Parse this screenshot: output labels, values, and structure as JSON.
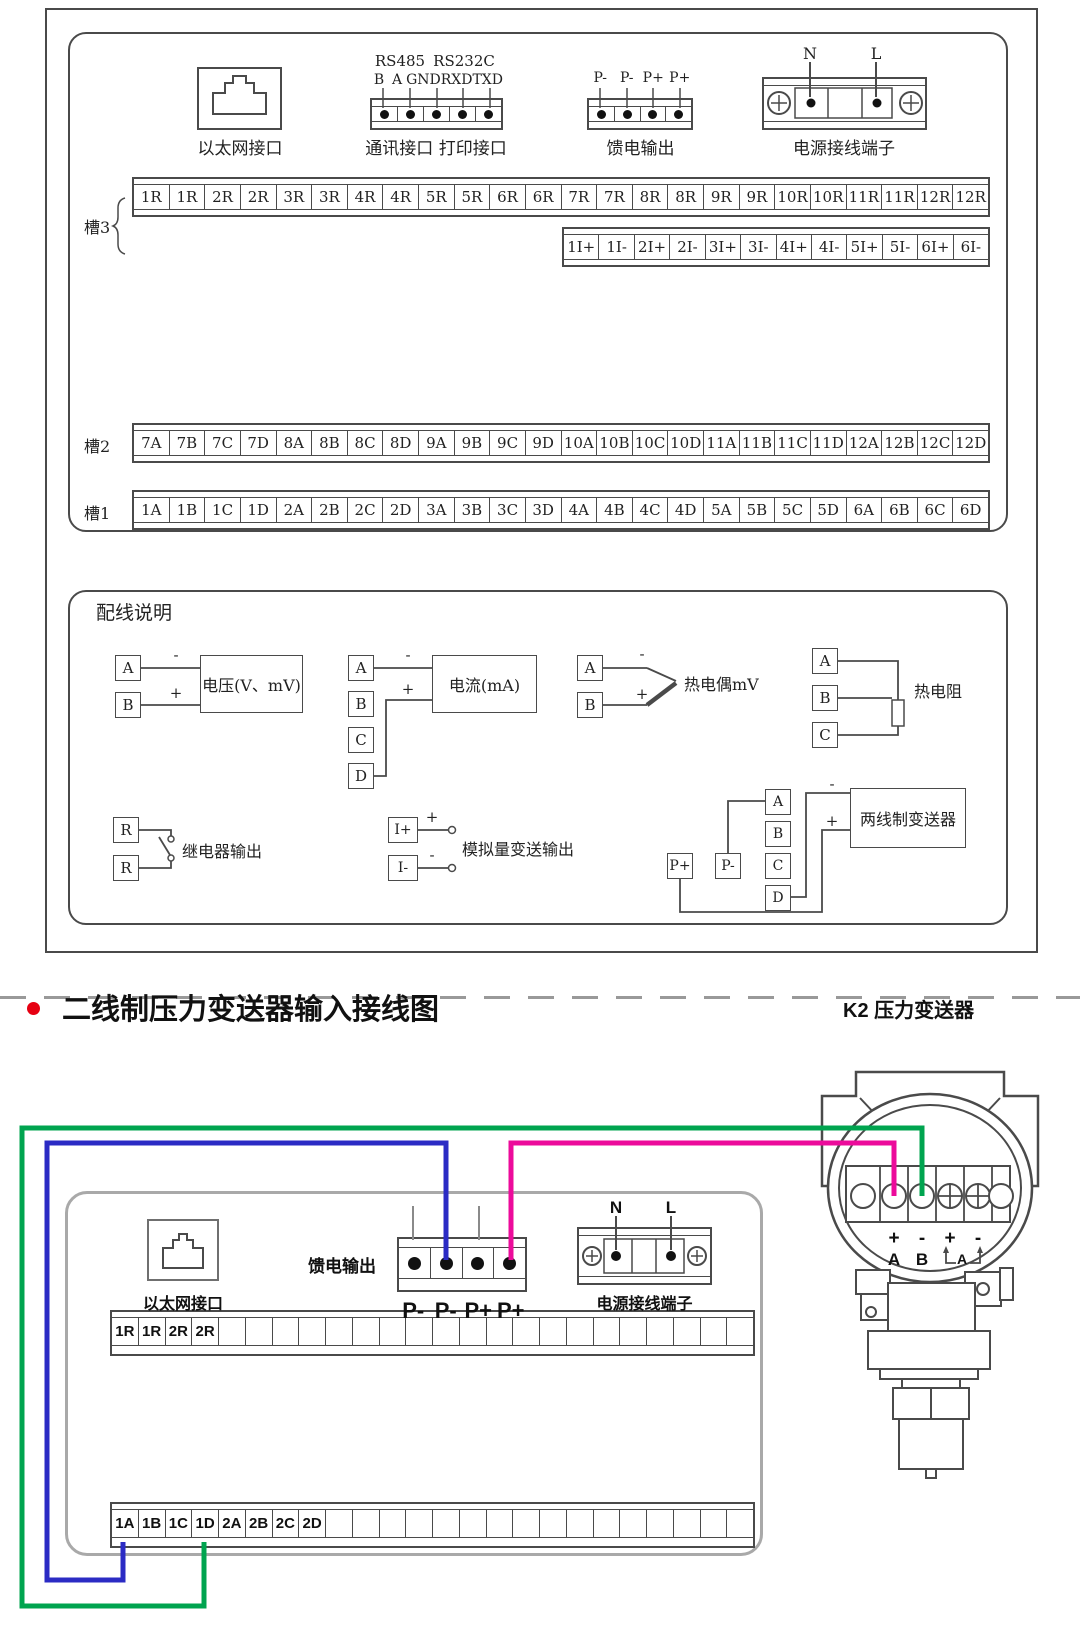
{
  "colors": {
    "wire_blue": "#2b2bc4",
    "wire_green": "#00a44f",
    "wire_magenta": "#ec0b9b",
    "bullet_red": "#e60012",
    "line_dark": "#4a4a4a",
    "panel_gray": "#a9a9a9"
  },
  "top": {
    "ethernet_label": "以太网接口",
    "comm": {
      "bus1": "RS485",
      "bus2": "RS232C",
      "pins": [
        "B",
        "A",
        "GND",
        "RXD",
        "TXD"
      ],
      "label": "通讯接口 打印接口"
    },
    "feed": {
      "pins": [
        "P-",
        "P-",
        "P+",
        "P+"
      ],
      "label": "馈电输出"
    },
    "power": {
      "n": "N",
      "l": "L",
      "label": "电源接线端子"
    },
    "slot3": "槽3",
    "slot2": "槽2",
    "slot1": "槽1",
    "slot3_r": [
      "1R",
      "1R",
      "2R",
      "2R",
      "3R",
      "3R",
      "4R",
      "4R",
      "5R",
      "5R",
      "6R",
      "6R",
      "7R",
      "7R",
      "8R",
      "8R",
      "9R",
      "9R",
      "10R",
      "10R",
      "11R",
      "11R",
      "12R",
      "12R"
    ],
    "slot3_i": [
      "1I+",
      "1I-",
      "2I+",
      "2I-",
      "3I+",
      "3I-",
      "4I+",
      "4I-",
      "5I+",
      "5I-",
      "6I+",
      "6I-"
    ],
    "slot2_cells": [
      "7A",
      "7B",
      "7C",
      "7D",
      "8A",
      "8B",
      "8C",
      "8D",
      "9A",
      "9B",
      "9C",
      "9D",
      "10A",
      "10B",
      "10C",
      "10D",
      "11A",
      "11B",
      "11C",
      "11D",
      "12A",
      "12B",
      "12C",
      "12D"
    ],
    "slot1_cells": [
      "1A",
      "1B",
      "1C",
      "1D",
      "2A",
      "2B",
      "2C",
      "2D",
      "3A",
      "3B",
      "3C",
      "3D",
      "4A",
      "4B",
      "4C",
      "4D",
      "5A",
      "5B",
      "5C",
      "5D",
      "6A",
      "6B",
      "6C",
      "6D"
    ]
  },
  "wiring": {
    "title": "配线说明",
    "voltage": {
      "t": [
        "A",
        "B"
      ],
      "minus": "-",
      "plus": "+",
      "label": "电压(V、mV)"
    },
    "current": {
      "t": [
        "A",
        "B",
        "C",
        "D"
      ],
      "minus": "-",
      "plus": "+",
      "label": "电流(mA)"
    },
    "tc": {
      "t": [
        "A",
        "B"
      ],
      "minus": "-",
      "plus": "+",
      "label": "热电偶mV"
    },
    "rtd": {
      "t": [
        "A",
        "B",
        "C"
      ],
      "label": "热电阻"
    },
    "relay": {
      "t": [
        "R",
        "R"
      ],
      "label": "继电器输出"
    },
    "analog": {
      "t": [
        "I+",
        "I-"
      ],
      "plus": "+",
      "minus": "-",
      "label": "模拟量变送输出"
    },
    "twowire": {
      "t": [
        "A",
        "B",
        "C",
        "D"
      ],
      "p": [
        "P+",
        "P-"
      ],
      "minus": "-",
      "plus": "+",
      "label": "两线制变送器"
    }
  },
  "bottom": {
    "title": "二线制压力变送器输入接线图",
    "k2": "K2 压力变送器",
    "ethernet_label": "以太网接口",
    "feed_label": "馈电输出",
    "feed_pins": [
      "P-",
      "P-",
      "P+",
      "P+"
    ],
    "power": {
      "n": "N",
      "l": "L",
      "label": "电源接线端子"
    },
    "strip_r": [
      "1R",
      "1R",
      "2R",
      "2R",
      "",
      "",
      "",
      "",
      "",
      "",
      "",
      "",
      "",
      "",
      "",
      "",
      "",
      "",
      "",
      "",
      "",
      "",
      "",
      ""
    ],
    "strip_a": [
      "1A",
      "1B",
      "1C",
      "1D",
      "2A",
      "2B",
      "2C",
      "2D",
      "",
      "",
      "",
      "",
      "",
      "",
      "",
      "",
      "",
      "",
      "",
      "",
      "",
      "",
      "",
      ""
    ],
    "tx": {
      "signs": [
        "+",
        "-",
        "+",
        "-"
      ],
      "letters": [
        "A",
        "B"
      ],
      "bracket": "A"
    }
  }
}
